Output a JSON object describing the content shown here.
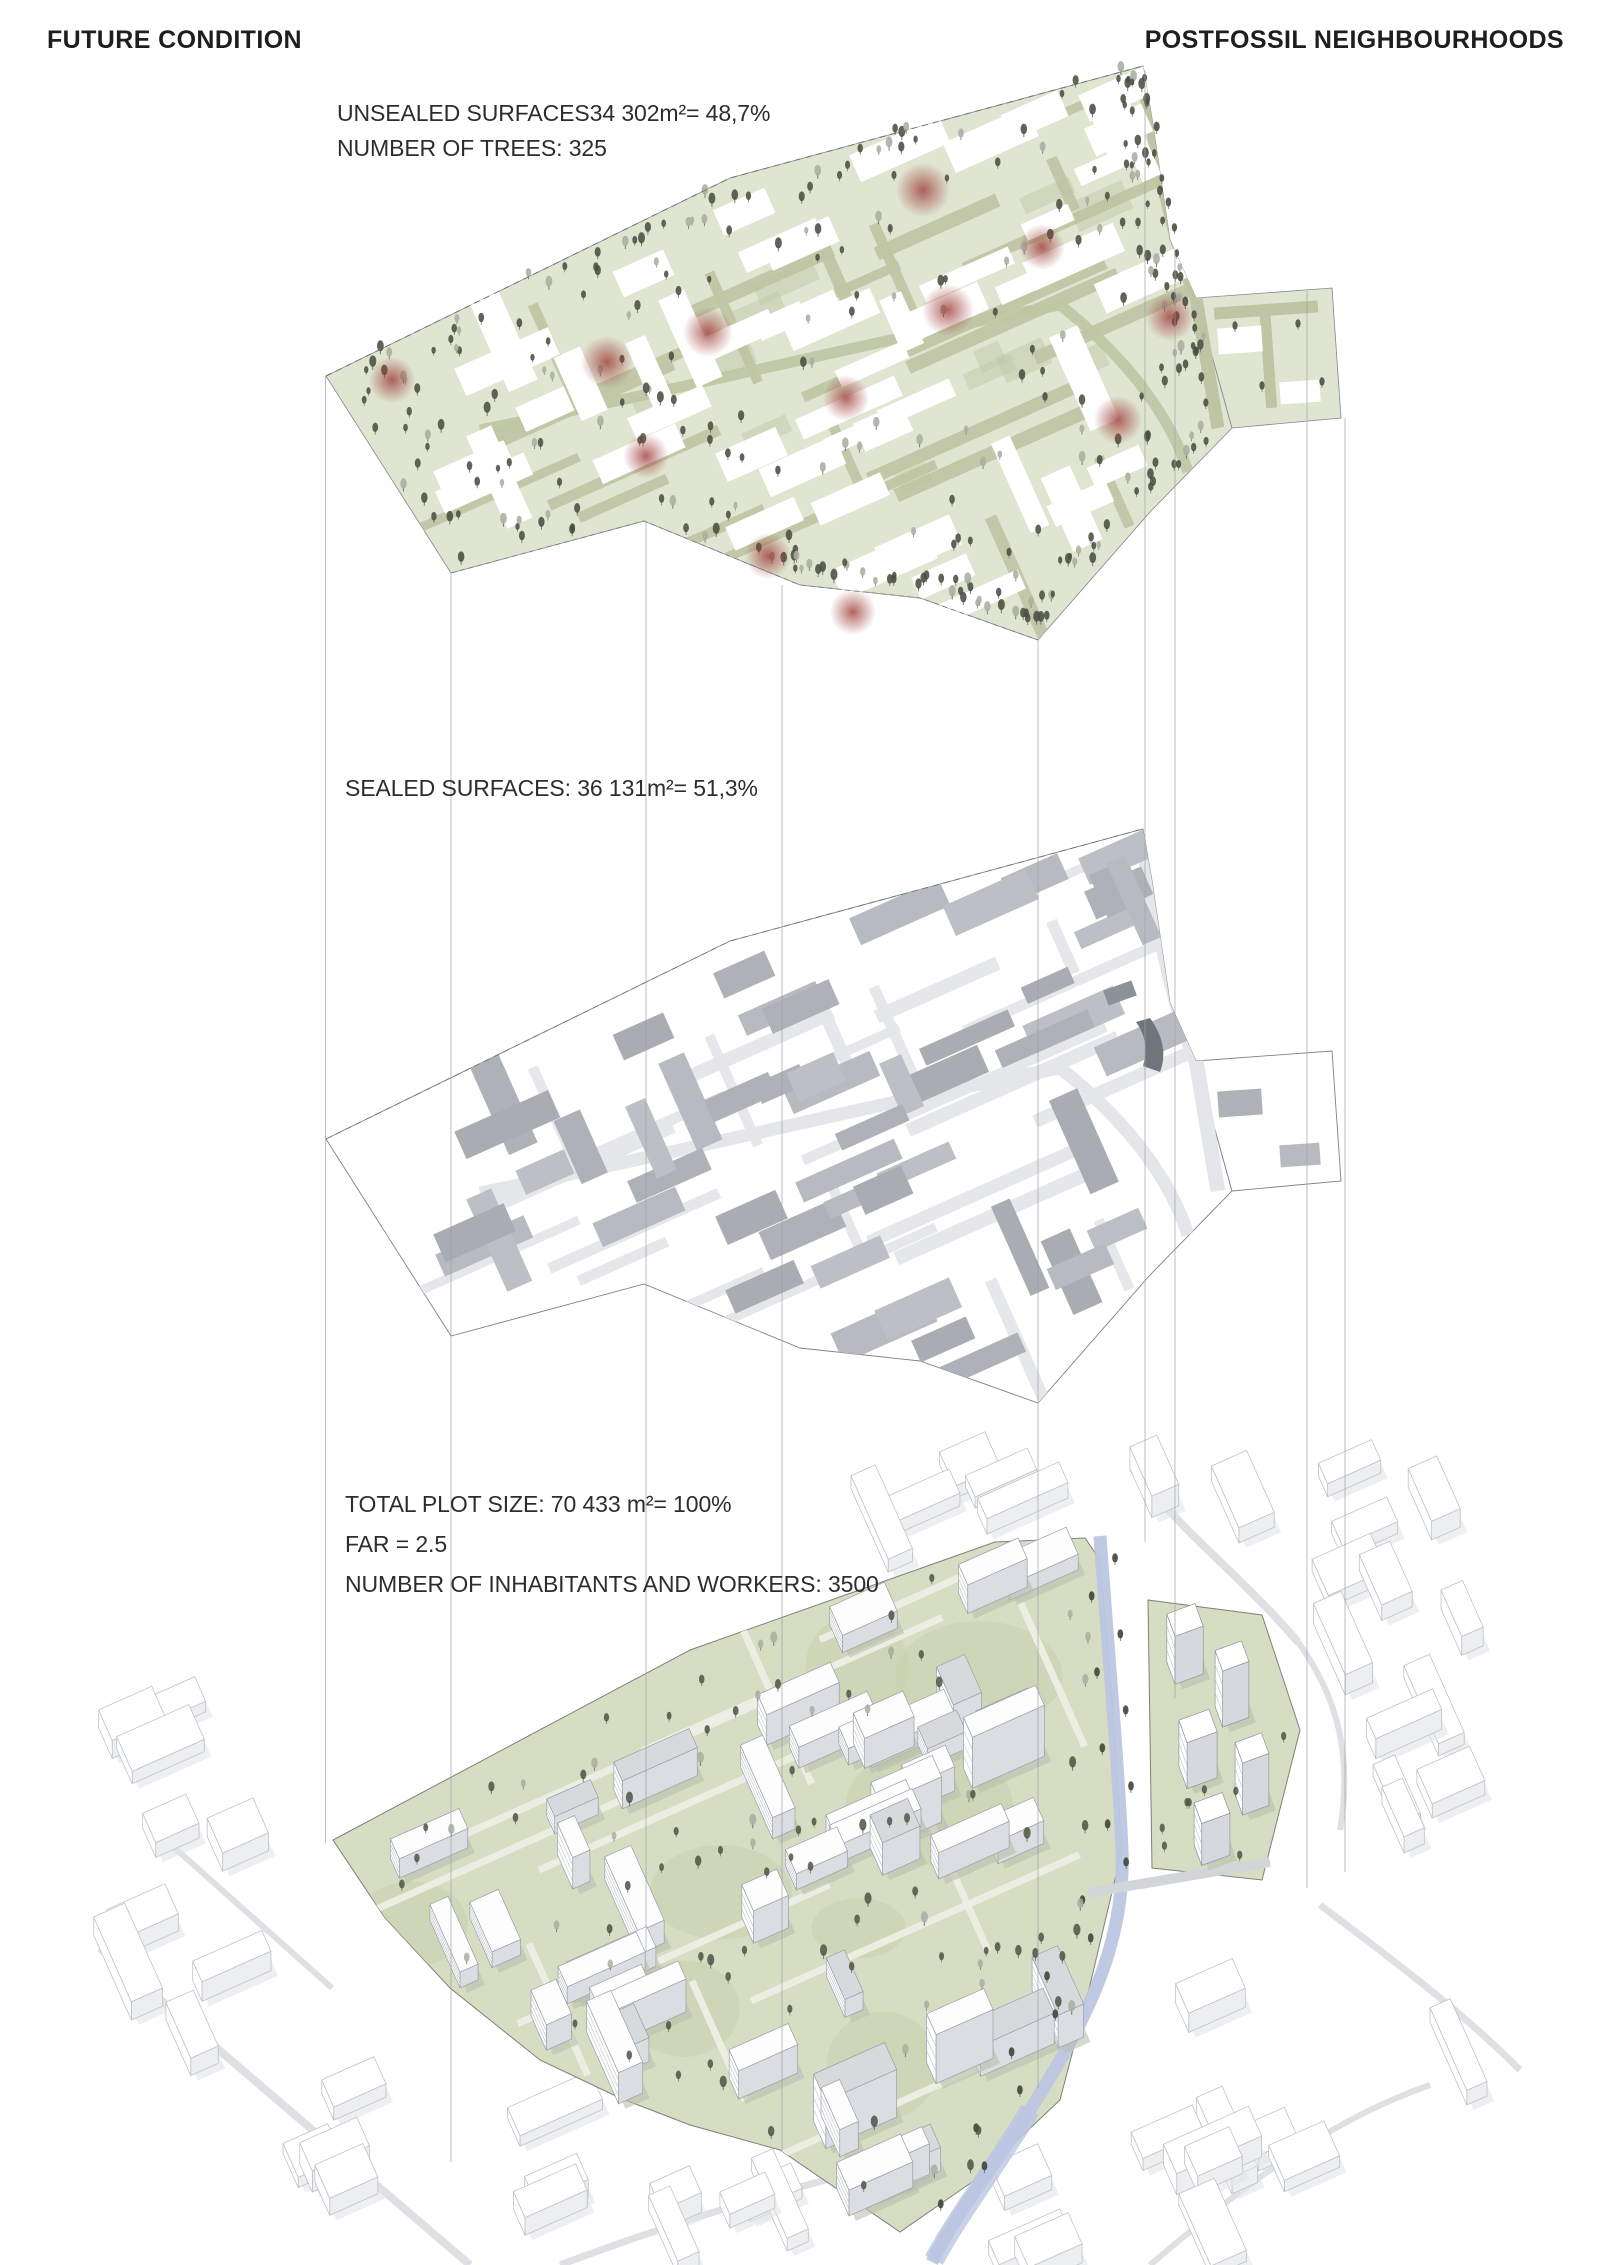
{
  "header": {
    "left_title": "FUTURE CONDITION",
    "right_title": "POSTFOSSIL NEIGHBOURHOODS"
  },
  "layers": {
    "unsealed": {
      "lines": [
        "UNSEALED SURFACES34 302m²= 48,7%",
        "NUMBER OF TREES: 325"
      ],
      "area": "34 302m²",
      "percent": "48,7%",
      "tree_count": 325
    },
    "sealed": {
      "lines": [
        "SEALED SURFACES: 36 131m²= 51,3%"
      ],
      "area": "36 131m²",
      "percent": "51,3%"
    },
    "total": {
      "lines": [
        "TOTAL PLOT SIZE: 70 433 m²= 100%",
        "FAR = 2.5",
        "NUMBER OF INHABITANTS AND WORKERS: 3500"
      ],
      "area": "70 433 m²",
      "percent": "100%",
      "far": "2.5",
      "inhabitants_and_workers": "3500"
    }
  },
  "diagram": {
    "red_spot_count": 12,
    "tree_count_top": 325,
    "tree_count_bottom": 95
  },
  "colors": {
    "site_green": "#e0e5d1",
    "road_olive": "#bfc5a4",
    "tree_dark": "#4a4f41",
    "tree_light": "#a8aea1",
    "red_spot": "#9c3a36",
    "building_gray": "#b4b8be",
    "road_gray": "#e4e6e9",
    "ground_green": "#d7ddc3",
    "river_blue": "#bcc6e2",
    "projection_line": "#9aa0a5",
    "outline": "#83888d",
    "context_stroke": "#bfc3c9",
    "context_shade": "#eceef0",
    "text": "#2d2d2d"
  }
}
